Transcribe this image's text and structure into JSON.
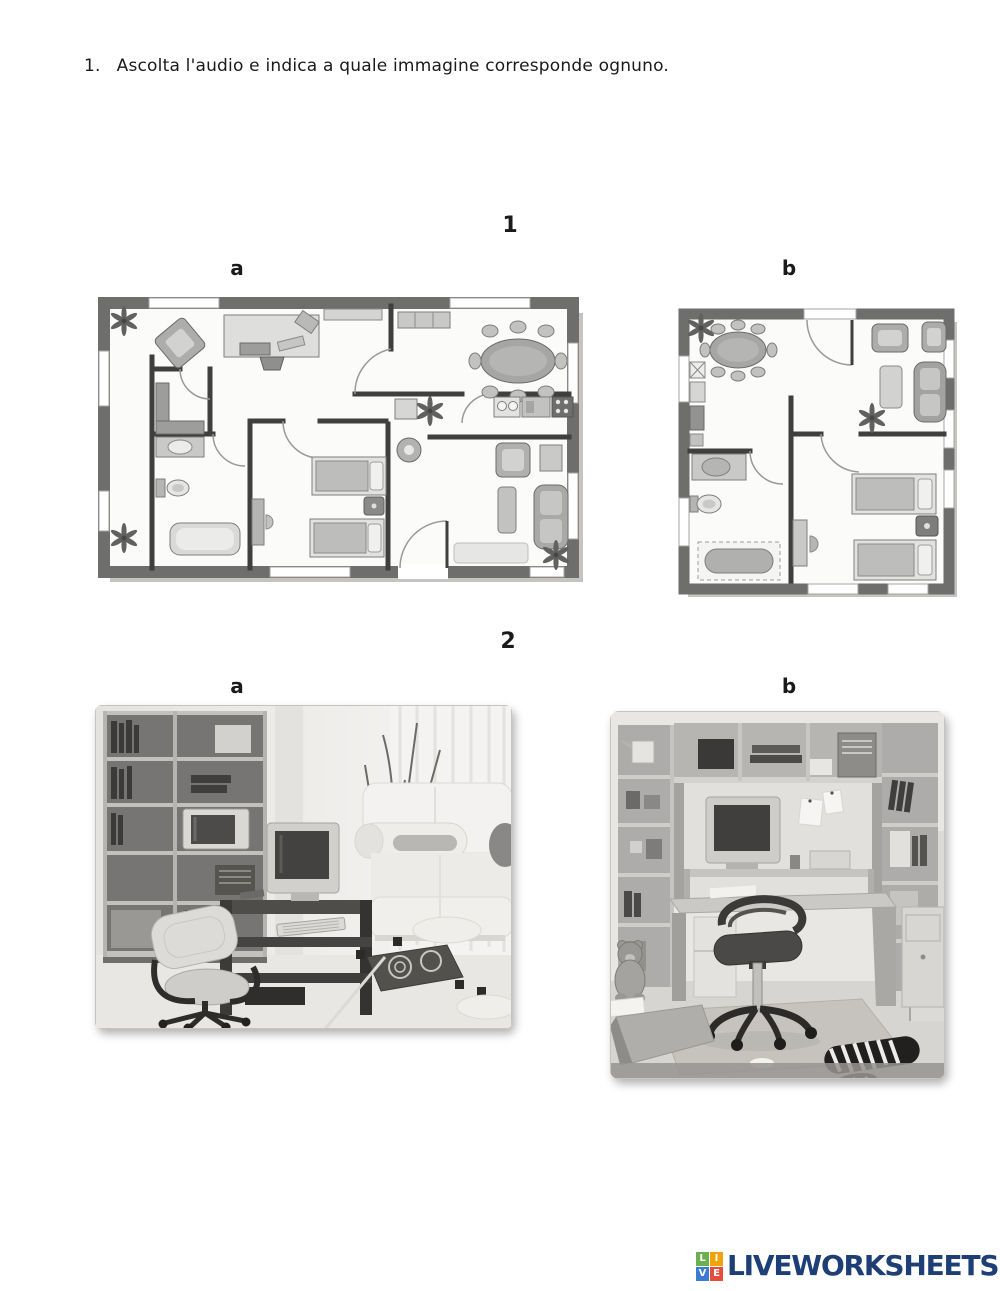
{
  "instruction": {
    "number": "1.",
    "text": "Ascolta l'audio e indica a quale immagine corresponde ognuno."
  },
  "exercise1": {
    "number": "1",
    "label_a": "a",
    "label_b": "b"
  },
  "exercise2": {
    "number": "2",
    "label_a": "a",
    "label_b": "b"
  },
  "footer": {
    "brand": "LIVEWORKSHEETS",
    "brand_color": "#1d3f76",
    "icon_letters": [
      "L",
      "I",
      "V",
      "E"
    ],
    "icon_colors": [
      "#6ab04c",
      "#f0a30a",
      "#3a7bd5",
      "#e84c3d"
    ]
  }
}
